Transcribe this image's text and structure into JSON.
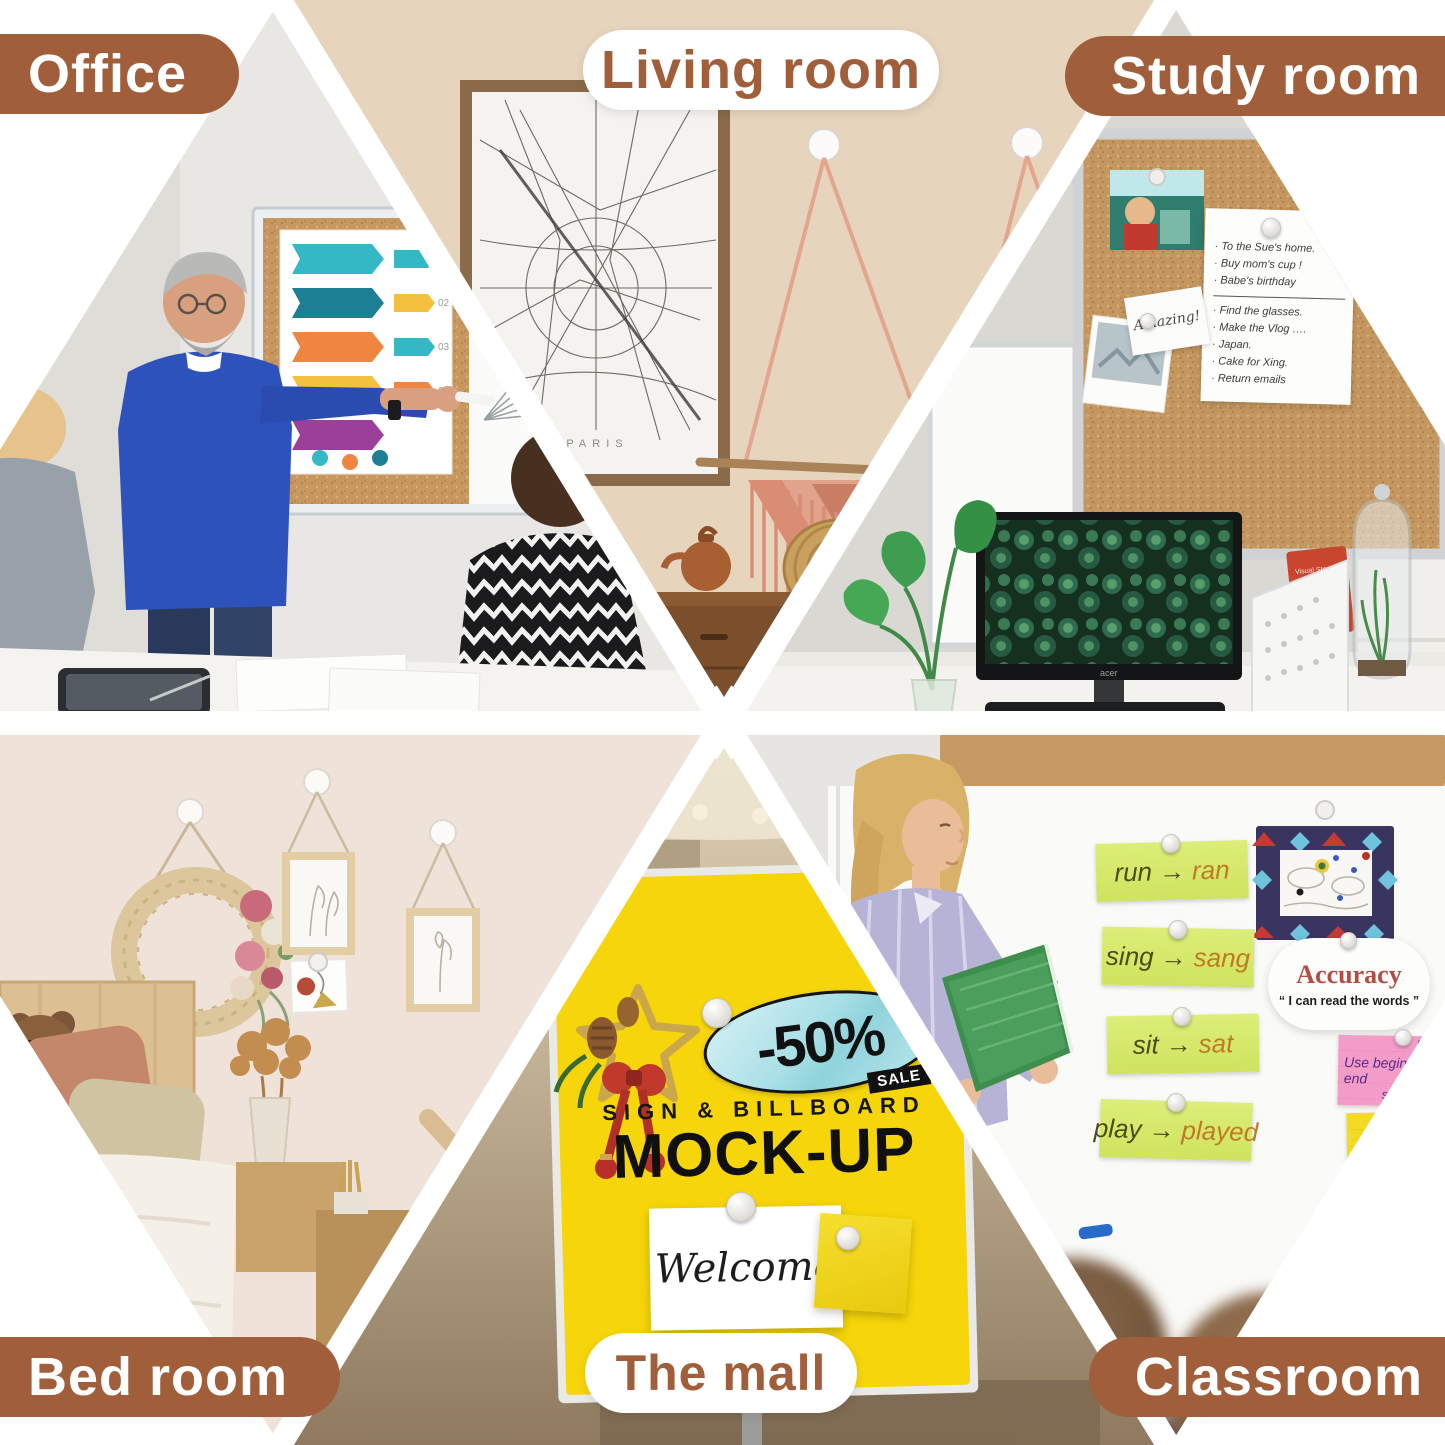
{
  "colors": {
    "accent_brown": "#A15E3B",
    "pill_white": "#FFFFFF",
    "sign_yellow": "#F6D50A",
    "oval_blue": "#AEE3E8",
    "cork": "#C79760",
    "living_wall_beige": "#E7D4BD",
    "bedroom_wall_blush": "#EFE2D8",
    "word_card_green": "#D6E96E",
    "card_pink": "#F49CC8",
    "card_yellow": "#F3DA26"
  },
  "sections": {
    "office": {
      "label": "Office",
      "poster_numbers": [
        "01",
        "02",
        "03",
        "04"
      ]
    },
    "living_room": {
      "label": "Living room",
      "map_caption": "PARIS"
    },
    "study_room": {
      "label": "Study room",
      "note": {
        "items_top": [
          "· To the Sue's home.",
          "· Buy mom's cup !",
          "· Babe's birthday"
        ],
        "items_bottom": [
          "· Find the glasses.",
          "· Make the Vlog ….",
          "· Japan.",
          "· Cake for Xing.",
          "· Return emails"
        ]
      },
      "amazing_card": "Amazing!",
      "book_title": "Visual Storytelling",
      "monitor_brand": "acer"
    },
    "bed_room": {
      "label": "Bed room"
    },
    "mall": {
      "label": "The mall",
      "sign": {
        "discount": "-50%",
        "sale_tag": "SALE",
        "subtitle": "SIGN & BILLBOARD",
        "title": "MOCK-UP",
        "welcome_note": "Welcome"
      }
    },
    "classroom": {
      "label": "Classroom",
      "arrow": "→",
      "word_cards": [
        {
          "from": "run",
          "to": "ran"
        },
        {
          "from": "sing",
          "to": "sang"
        },
        {
          "from": "sit",
          "to": "sat"
        },
        {
          "from": "play",
          "to": "played"
        }
      ],
      "accuracy_sign": {
        "title": "Accuracy",
        "quote": "“ I can read the words ”"
      },
      "pink_card": {
        "word": "blanket",
        "line1": "Use beginning and end",
        "line2": "sounds."
      },
      "yellow_card": {
        "title": "Chunking",
        "subtitle": "imitate"
      }
    }
  }
}
